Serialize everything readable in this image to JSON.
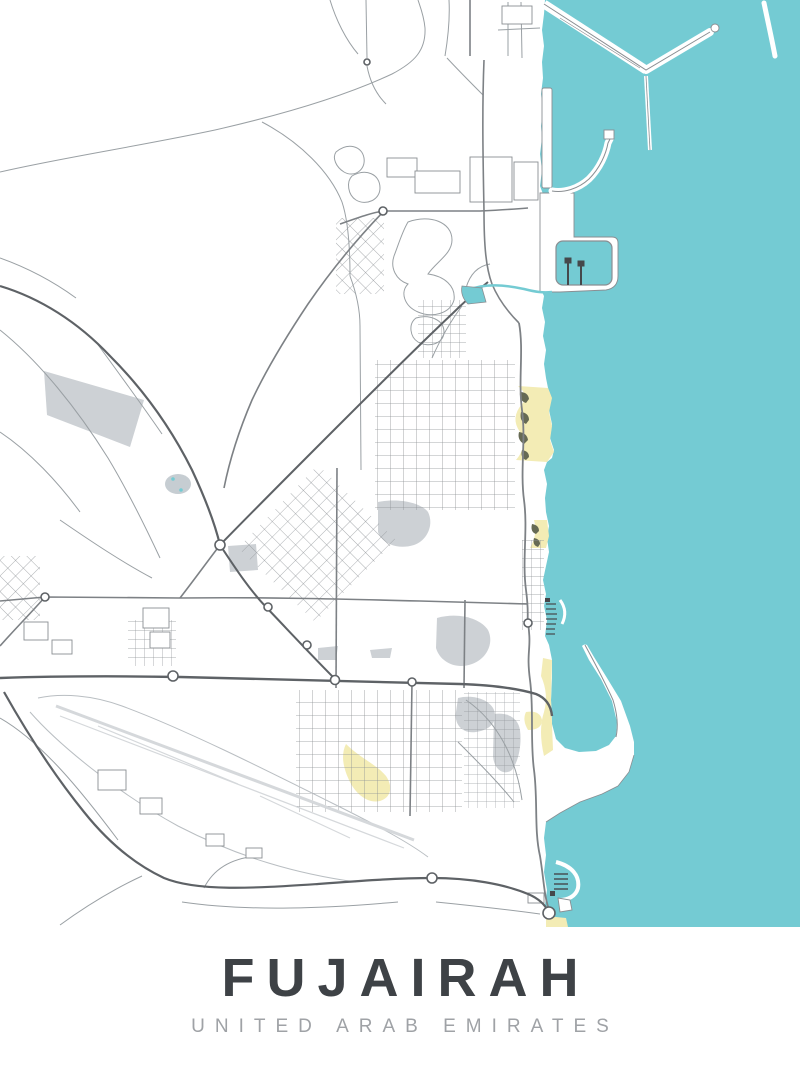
{
  "poster": {
    "title": "FUJAIRAH",
    "subtitle": "UNITED ARAB EMIRATES"
  },
  "colors": {
    "water": "#74cbd3",
    "land": "#ffffff",
    "beach": "#f3ecb5",
    "dune": "#666a54",
    "zone": "#cdd1d5",
    "pond": "#c6cdd2",
    "runway": "#d5d8db",
    "airport_line": "#b9bec2",
    "road_minor": "#9aa0a4",
    "road_medium": "#7d8185",
    "road_major": "#5e6266",
    "outline": "#8a8e92",
    "boat": "#45484b",
    "title_text": "#3e4246",
    "subtitle_text": "#9fa2a6"
  }
}
